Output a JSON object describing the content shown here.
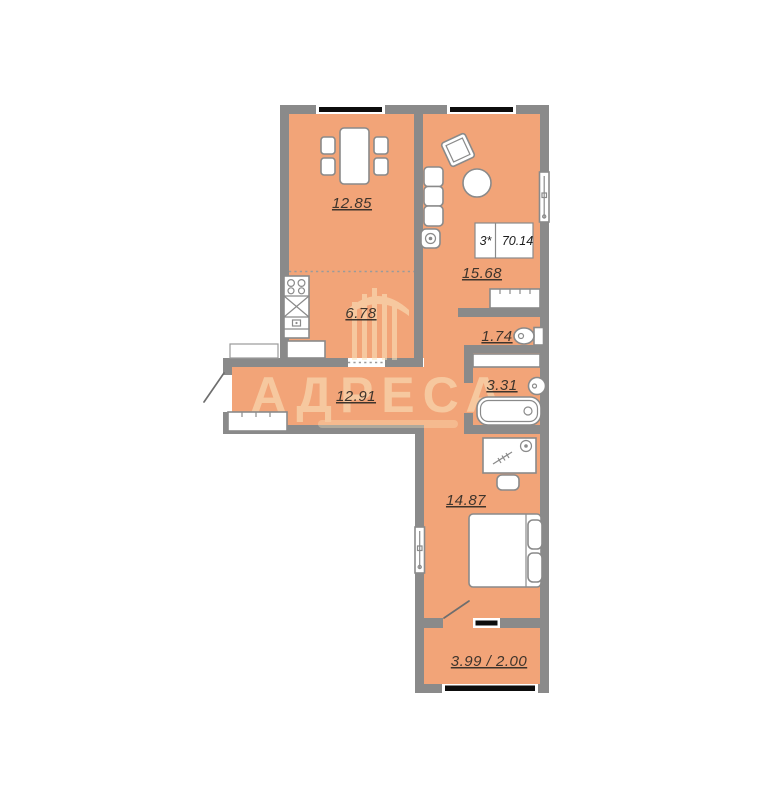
{
  "floor_plan": {
    "watermark": "АДРЕСА",
    "info_box": {
      "rooms": "3*",
      "total_area": "70.14"
    },
    "rooms": {
      "dining": "12.85",
      "kitchen": "6.78",
      "living": "15.68",
      "toilet": "1.74",
      "bathroom": "3.31",
      "hallway": "12.91",
      "bedroom": "14.87",
      "balcony": "3.99 / 2.00"
    },
    "colors": {
      "floor": "#F2A478",
      "wall": "#8A8A8A",
      "window_glass": "#0D0D0D",
      "label_text": "#3E342C",
      "watermark": "#FBE7C0"
    }
  }
}
